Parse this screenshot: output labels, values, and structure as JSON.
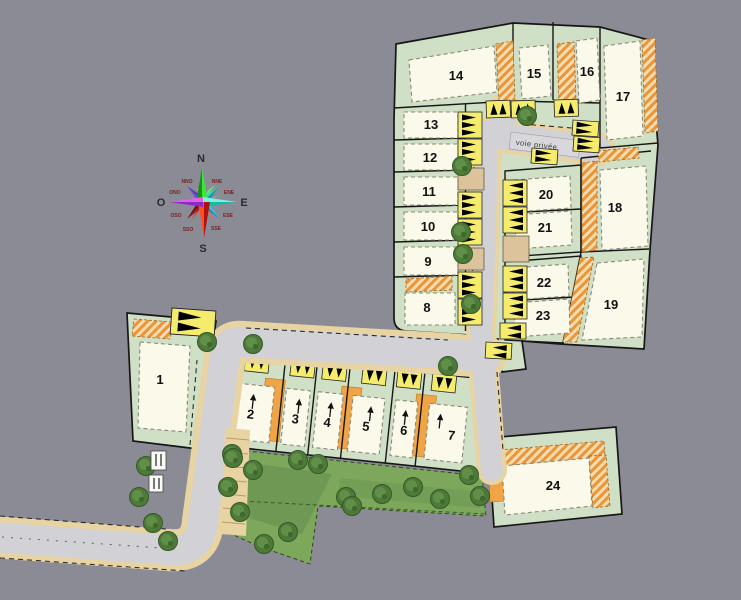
{
  "scene": {
    "road_label": "voie privée",
    "lots": [
      "1",
      "2",
      "3",
      "4",
      "5",
      "6",
      "7",
      "8",
      "9",
      "10",
      "11",
      "12",
      "13",
      "14",
      "15",
      "16",
      "17",
      "18",
      "19",
      "20",
      "21",
      "22",
      "23",
      "24"
    ],
    "compass": {
      "n": "N",
      "e": "E",
      "s": "S",
      "o": "O",
      "nno": "NNO",
      "nne": "NNE",
      "ene": "ENE",
      "ese": "ESE",
      "sse": "SSE",
      "sso": "SSO",
      "oso": "OSO",
      "ono": "ONO"
    },
    "colors": {
      "background": "#8b8b95",
      "parcel_green": "#cfe0c6",
      "building_cream": "#fbf9ea",
      "garage_orange": "#f0a445",
      "hatch_orange": "#e8953b",
      "marker_yellow": "#f5ec6e",
      "road_gray": "#d2d2d6",
      "sidewalk_tan": "#e7d4a2",
      "park_green": "#7da75b",
      "tree_green": "#4d7a38"
    }
  }
}
